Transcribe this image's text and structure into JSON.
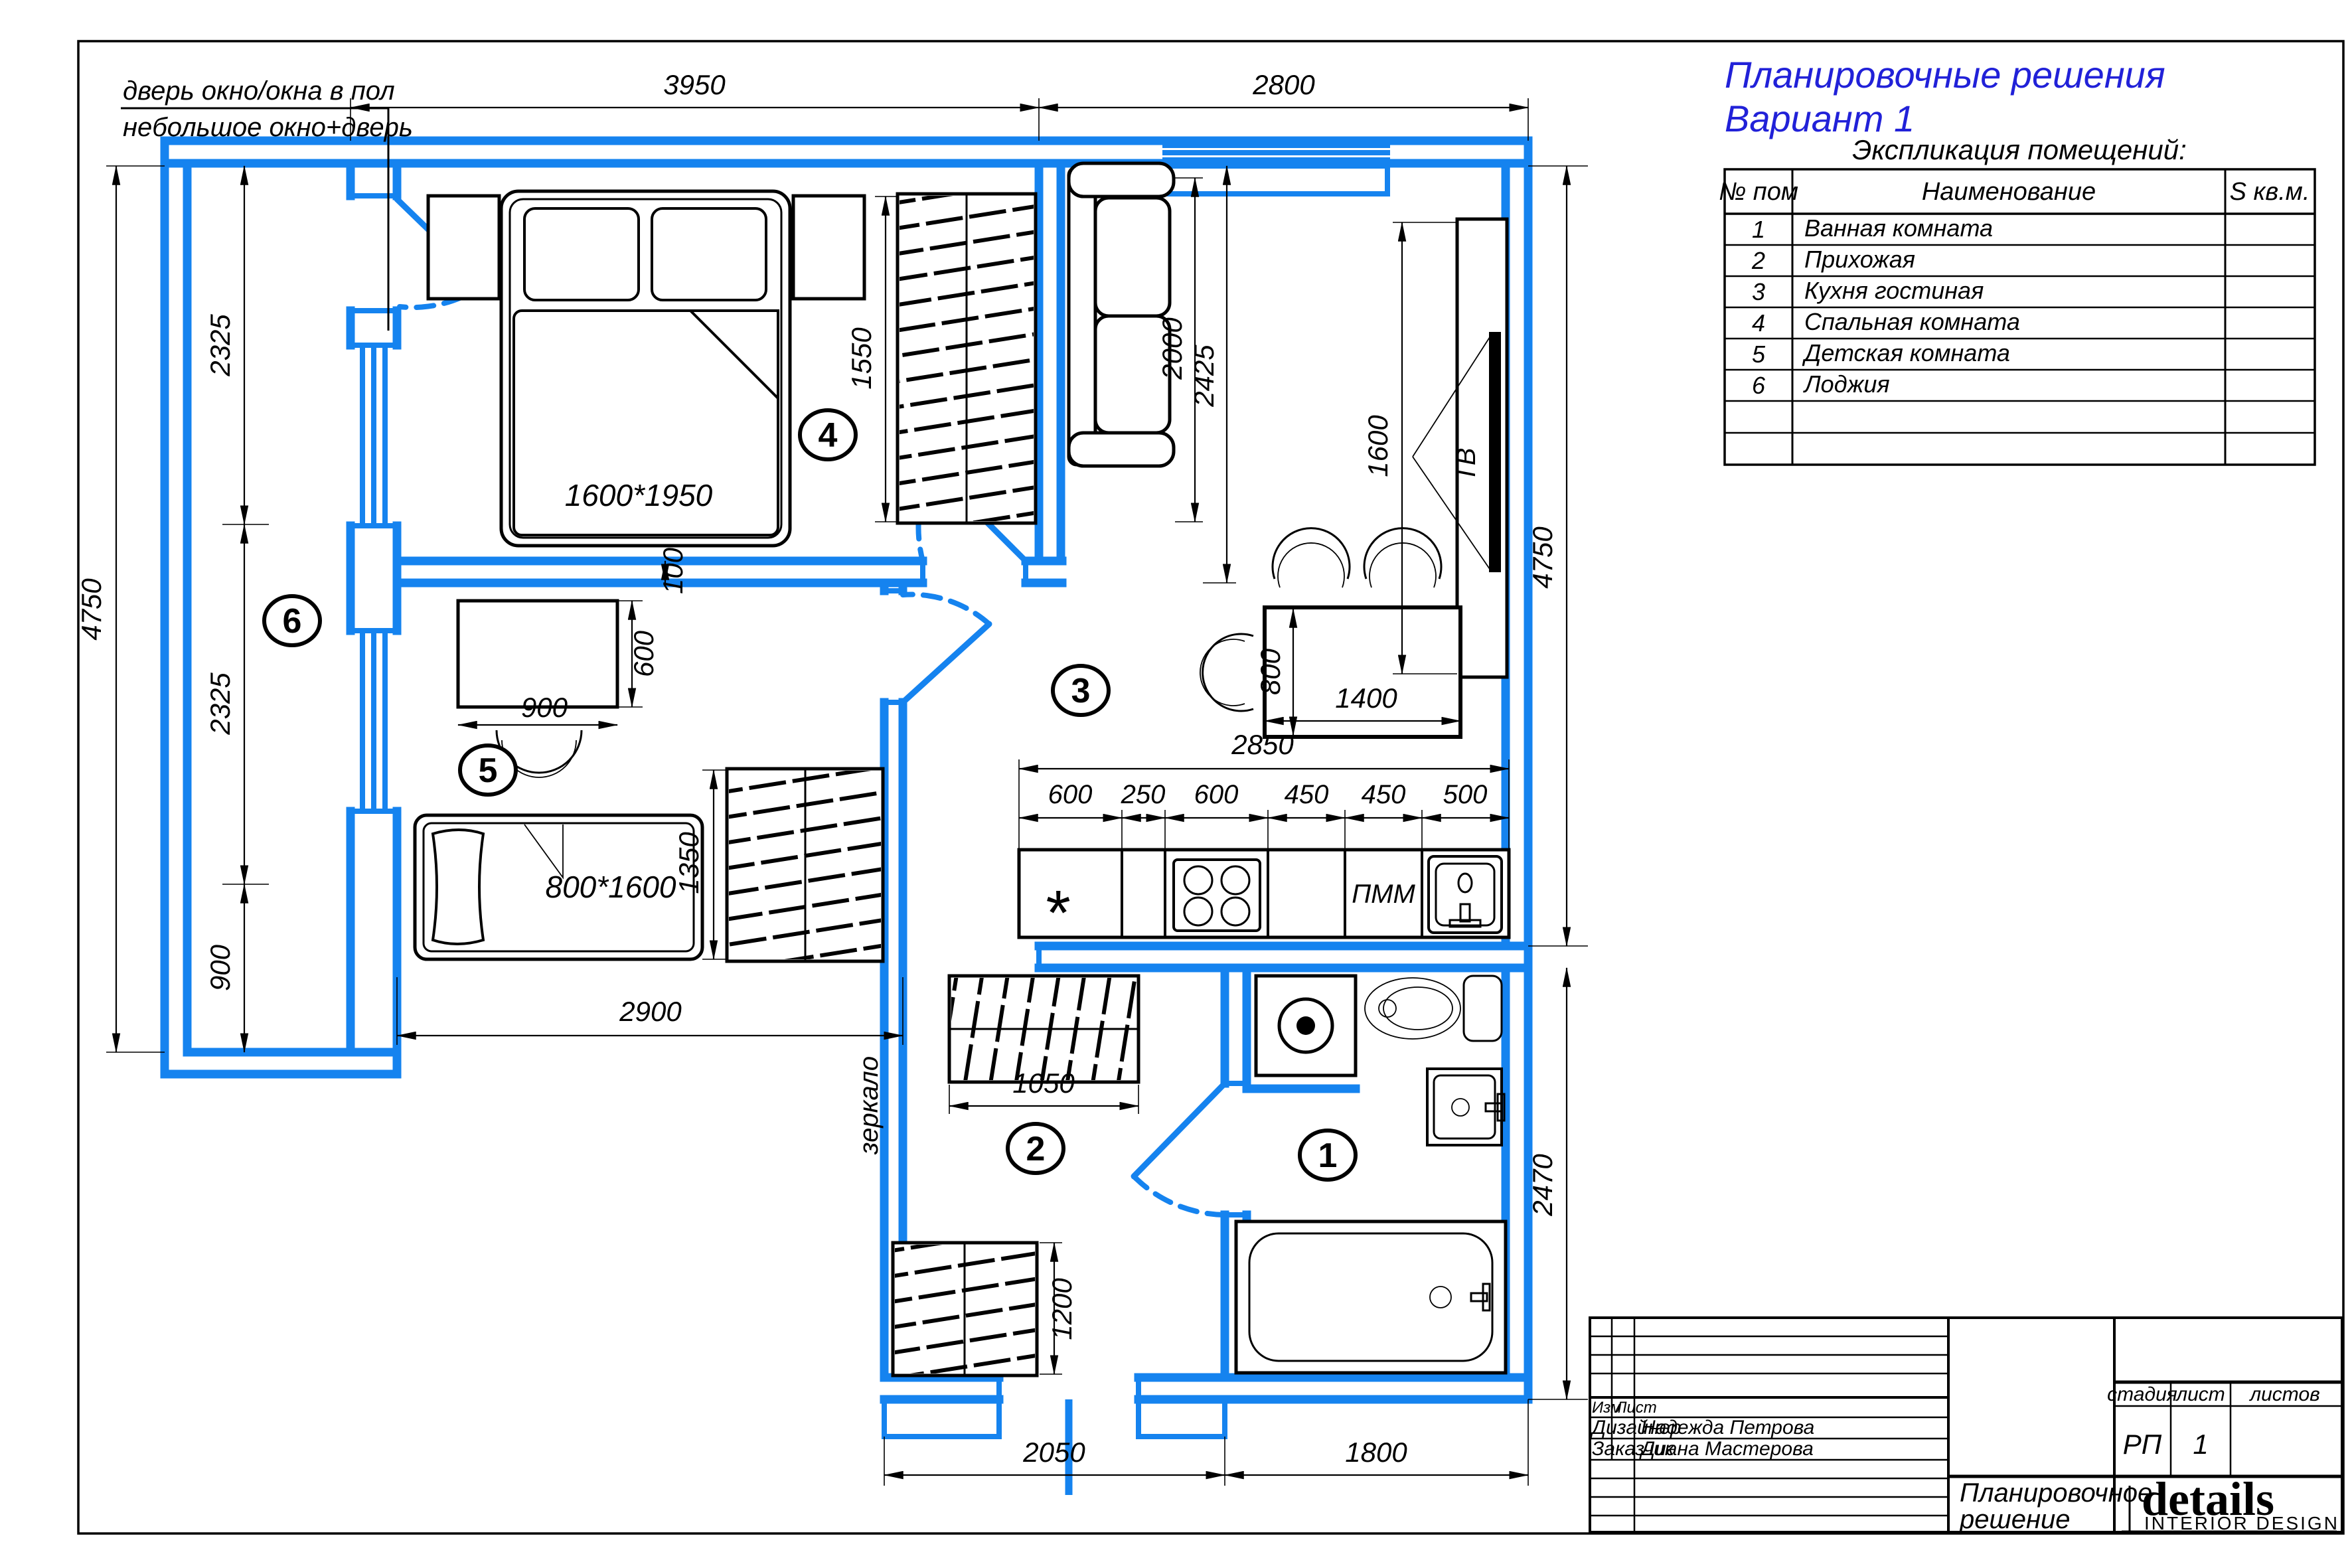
{
  "colors": {
    "wall_blue": "#1583ef",
    "heading_blue": "#2121d8"
  },
  "notes": {
    "line1": "дверь окно/окна в пол",
    "line2": "небольшое окно+дверь",
    "mirror": "зеркало"
  },
  "heading": {
    "line1": "Планировочные решения",
    "line2": "Вариант 1"
  },
  "legend": {
    "title": "Экспликация помещений:",
    "col_num": "№ пом",
    "col_name": "Наименование",
    "col_area": "S кв.м.",
    "rows": [
      {
        "num": "1",
        "name": "Ванная комната"
      },
      {
        "num": "2",
        "name": "Прихожая"
      },
      {
        "num": "3",
        "name": "Кухня гостиная"
      },
      {
        "num": "4",
        "name": "Спальная комната"
      },
      {
        "num": "5",
        "name": "Детская комната"
      },
      {
        "num": "6",
        "name": "Лоджия"
      }
    ]
  },
  "room_labels": {
    "r1": "1",
    "r2": "2",
    "r3": "3",
    "r4": "4",
    "r5": "5",
    "r6": "6"
  },
  "furniture": {
    "bed_double": "1600*1950",
    "bed_single": "800*1600",
    "tv": "ТВ",
    "dishwasher": "ПММ",
    "fridge_mark": "*"
  },
  "dims": {
    "top_bedroom": "3950",
    "top_living": "2800",
    "left_total": "4750",
    "left_seg1": "2325",
    "left_seg2": "2325",
    "left_seg3": "900",
    "right_living": "4750",
    "right_bath": "2470",
    "bedroom_wardrobe": "1550",
    "desk_depth": "600",
    "desk_width": "900",
    "wall_gap": "100",
    "kids_wardrobe": "1350",
    "kids_width": "2900",
    "sofa_len": "2000",
    "sofa_zone": "2425",
    "tv_len": "1600",
    "table_w": "1400",
    "table_d": "800",
    "kitchen_total": "2850",
    "kitchen_segs": [
      "600",
      "250",
      "600",
      "450",
      "450",
      "500"
    ],
    "hall_wardrobe": "1050",
    "hall_wardrobe2": "1200",
    "hall_width": "2050",
    "bath_width": "1800"
  },
  "titleblock": {
    "izm": "Изм",
    "list": "Лист",
    "designer_label": "Дизайнер",
    "designer_name": "Надежда Петрова",
    "client_label": "Заказчик",
    "client_name": "Диана Мастерова",
    "stage_label": "стадия",
    "sheet_label": "лист",
    "sheets_label": "листов",
    "stage_value": "РП",
    "sheet_value": "1",
    "doc_line1": "Планировочное",
    "doc_line2": "решение",
    "brand": "details",
    "brand_sub": "INTERIOR DESIGN"
  }
}
